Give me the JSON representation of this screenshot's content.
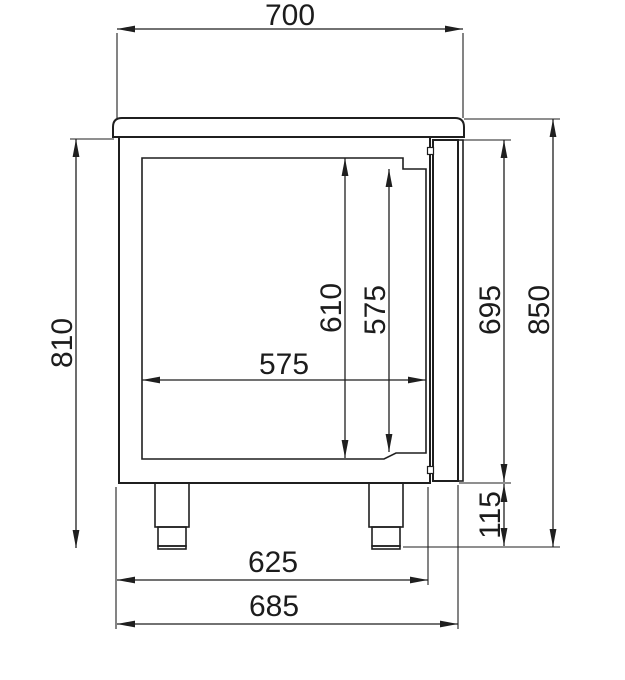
{
  "drawing": {
    "kind": "technical-dimension-drawing",
    "background_color": "#ffffff",
    "line_color": "#1f1f1f",
    "text_color": "#1c1c1c"
  },
  "dimensions": {
    "worktop_width": "700",
    "body_height": "810",
    "inner_height_left": "610",
    "inner_height_right": "575",
    "inner_width": "575",
    "door_height": "695",
    "total_height": "850",
    "leg_height": "115",
    "body_width": "625",
    "overall_width": "685"
  }
}
